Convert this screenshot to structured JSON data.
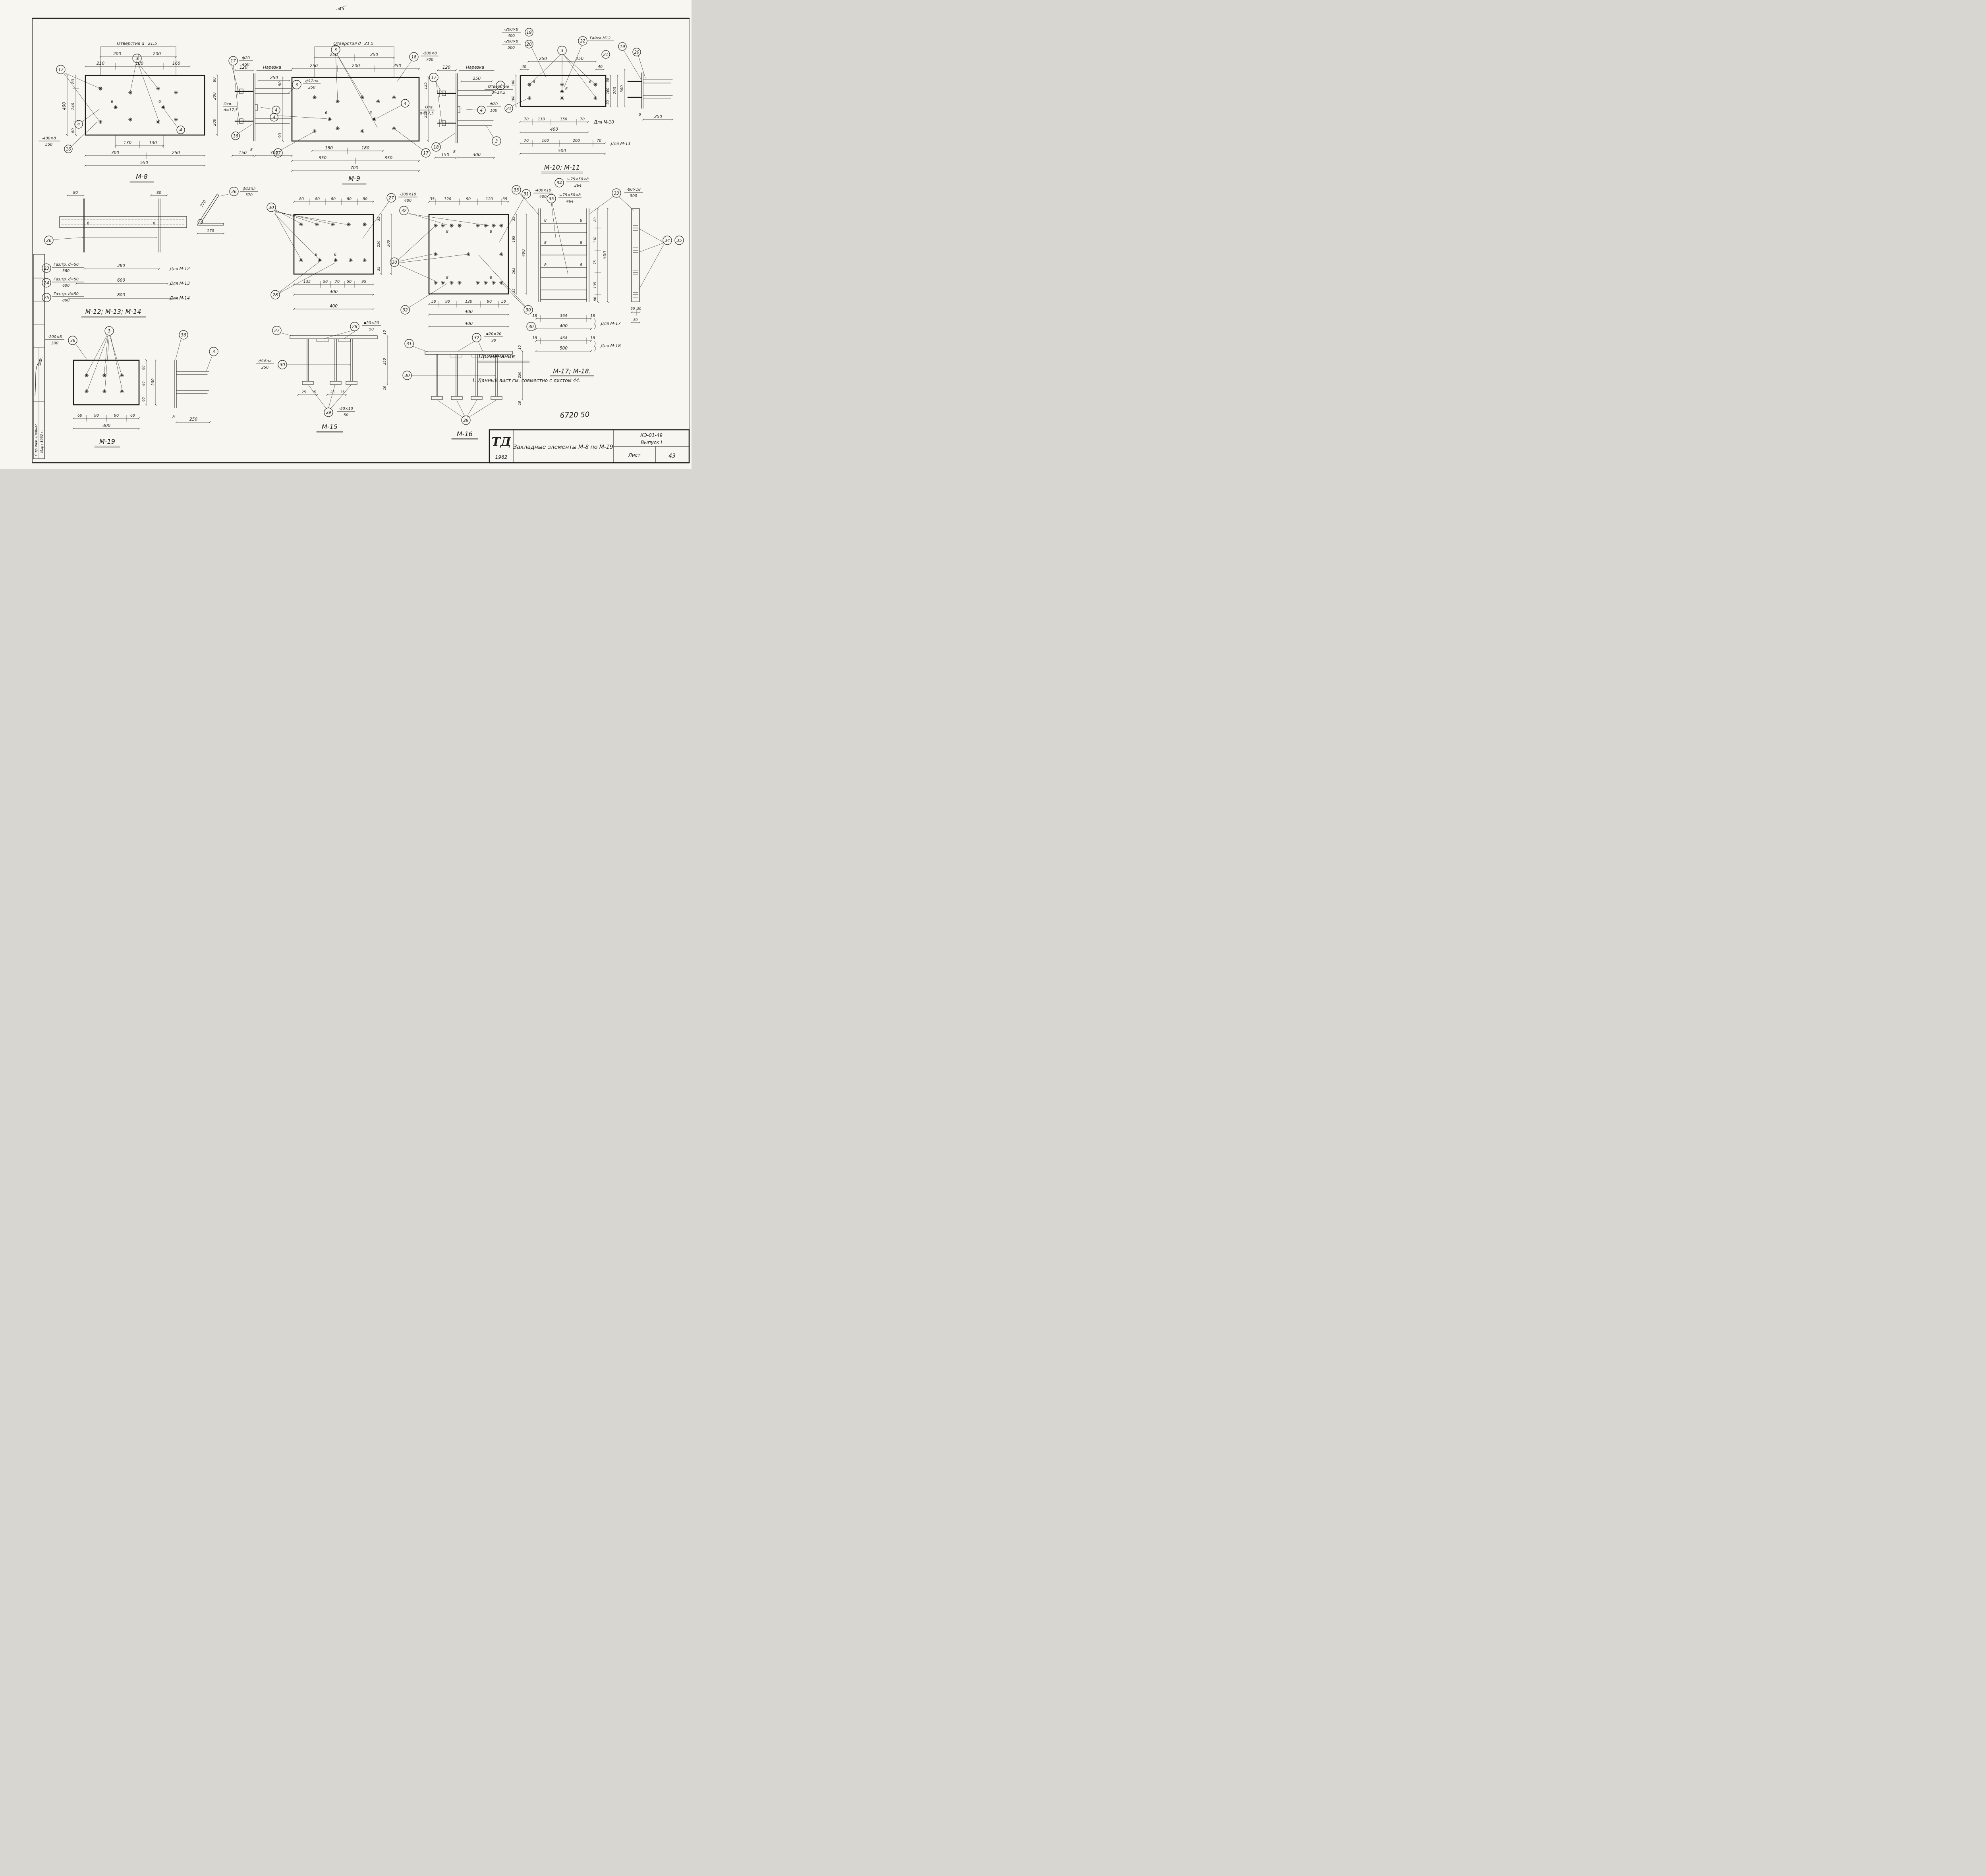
{
  "page": {
    "corner_mark": "45",
    "handnote": "6720 50",
    "ink": "#1d1d1b",
    "paper": "#f7f6f1"
  },
  "titleblock": {
    "logo": "ТД",
    "year": "1962",
    "title": "Закладные элементы М-8 по М-19",
    "doc": "КЭ-01-49",
    "issue": "Выпуск I",
    "sheet_label": "Лист",
    "sheet_no": "43"
  },
  "notes": {
    "heading": "Примечания",
    "item1": "1. Данный лист см. совместно с листом 44."
  },
  "stamp": {
    "sig_label": "С.тр.инж. Шейнес",
    "date_label": "Март 1962 г."
  },
  "views": {
    "m8": {
      "label": "М-8",
      "holes_note": "Отверстия d=21,5",
      "t200a": "200",
      "t200b": "200",
      "t210": "210",
      "t180": "180",
      "t160": "160",
      "l80a": "80",
      "l240": "240",
      "l80b": "80",
      "l400": "400",
      "r80": "80",
      "s200a": "200",
      "s200b": "200",
      "otv": "Отв.",
      "otv_d": "d=17,5",
      "w6a": "6",
      "w6b": "6",
      "b130a": "130",
      "b130b": "130",
      "b300": "300",
      "b250": "250",
      "b550": "550",
      "note16_num": "-400×8",
      "note16_den": "550",
      "note17_num": "ф20",
      "note17_den": "450",
      "note3_num": "ф12пл",
      "note3_den": "250",
      "s120": "120",
      "thread": "Нарезка",
      "s250": "250",
      "s8": "8",
      "s150": "150",
      "s300": "300",
      "c17l": "17",
      "c3": "3",
      "c17r": "17",
      "c4a": "4",
      "c4b": "4",
      "c4c": "4",
      "c16a": "16",
      "c16b": "16",
      "c3r": "3"
    },
    "m9": {
      "label": "М-9",
      "holes_note": "Отверстия d=21,5",
      "t250a": "250",
      "t250b": "250",
      "r250a": "250",
      "r200": "200",
      "r250b": "250",
      "note18_num": "-500×8",
      "note18_den": "700",
      "l90a": "90",
      "l90b": "90",
      "rv125": "125",
      "rv250": "250",
      "otv": "Отв.",
      "otv_d": "d=17,5",
      "w6a": "6",
      "w6b": "6",
      "b180a": "180",
      "b180b": "180",
      "b350a": "350",
      "b350b": "350",
      "b700": "700",
      "s120": "120",
      "thread": "Нарезка",
      "s250": "250",
      "s8": "8",
      "s150": "150",
      "s300": "300",
      "c3": "3",
      "c18": "18",
      "c4a": "4",
      "c4b": "4",
      "c17a": "17",
      "c17b": "17",
      "c17s": "17",
      "c18s": "18",
      "c3s": "3",
      "c3sb": "3",
      "c4s": "4"
    },
    "m1011": {
      "label": "М-10; М-11",
      "note19_num": "-200×8",
      "note19_den": "400",
      "note20_num": "-200×8",
      "note20_den": "500",
      "nut": "Гайка М12",
      "t250a": "250",
      "t250b": "250",
      "t40a": "40",
      "t40b": "40",
      "otv": "Отверстие",
      "otv_d": "d=14,5",
      "note21_num": "ф20",
      "note21_den": "100",
      "l100a": "100",
      "l100b": "100",
      "rv50a": "50",
      "rv100": "100",
      "rv50b": "50",
      "rv200": "200",
      "rv300": "300",
      "w6a": "6",
      "w6b": "6",
      "w6c": "6",
      "row1": [
        "70",
        "110",
        "150",
        "70"
      ],
      "row1_total": "400",
      "row1_for": "Для М-10",
      "row2": [
        "70",
        "160",
        "200",
        "70"
      ],
      "row2_total": "500",
      "row2_for": "Для М-11",
      "s8": "8",
      "s250": "250",
      "c19a": "19",
      "c19b": "19",
      "c20a": "20",
      "c20b": "20",
      "c21a": "21",
      "c21b": "21",
      "c22": "22",
      "c3": "3"
    },
    "m121314": {
      "label": "М-12; М-13; М-14",
      "t80a": "80",
      "t80b": "80",
      "w6a": "6",
      "w6b": "6",
      "c26a": "26",
      "c26b": "26",
      "c23": "23",
      "c24": "24",
      "c25": "25",
      "gas1": "Газ.тр. d=50",
      "gas2": "Газ.тр. d=50",
      "gas3": "Газ.тр. d=50",
      "den1": "380",
      "den2": "600",
      "den3": "800",
      "len1": "380",
      "len2": "600",
      "len3": "800",
      "for1": "Для М-12",
      "for2": "Для М-13",
      "for3": "Для М-14",
      "note26_num": "ф12пл",
      "note26_den": "570",
      "d270": "270",
      "d170": "170"
    },
    "m15": {
      "label": "М-15",
      "top": [
        "80",
        "80",
        "80",
        "80",
        "80"
      ],
      "c30a": "30",
      "c27a": "27",
      "note27_num": "-300×10",
      "note27_den": "400",
      "rv": [
        "35",
        "230",
        "35"
      ],
      "rv300": "300",
      "bot": [
        "135",
        "50",
        "70",
        "50",
        "95"
      ],
      "b400": "400",
      "w6a": "6",
      "w6b": "6",
      "c28a": "28",
      "c27s": "27",
      "c28s": "28",
      "note28_num": "▪20×20",
      "note28_den": "50",
      "s400": "400",
      "sv": [
        "10",
        "250",
        "10"
      ],
      "note30_num": "ф16пл",
      "note30_den": "250",
      "c30s": "30",
      "sb": [
        "25",
        "35",
        "25",
        "35"
      ],
      "c29": "29",
      "note29_num": "-50×10",
      "note29_den": "50"
    },
    "m16": {
      "label": "М-16",
      "top": [
        "35",
        "120",
        "90",
        "120",
        "35"
      ],
      "c31a": "31",
      "note31_num": "-400×10",
      "note31_den": "400",
      "c32a": "32",
      "c32b": "32",
      "c32s": "32",
      "c30a": "30",
      "c30b": "30",
      "c30s": "30",
      "c30t": "30",
      "w8": [
        "8",
        "8",
        "8",
        "8"
      ],
      "rv": [
        "35",
        "165",
        "165",
        "35"
      ],
      "rv400": "400",
      "bot": [
        "50",
        "90",
        "120",
        "90",
        "50"
      ],
      "b400": "400",
      "s400": "400",
      "sv": [
        "10",
        "250",
        "10"
      ],
      "c31s": "31",
      "note32_num": "▪20×20",
      "note32_den": "90",
      "c29": "29"
    },
    "m1718": {
      "label": "М-17; М-18.",
      "c33a": "33",
      "c33b": "33",
      "c34a": "34",
      "c34b": "34",
      "c35a": "35",
      "c35b": "35",
      "note34_num": "∟75×50×8",
      "note34_den": "364",
      "note35_num": "∟75×50×8",
      "note35_den": "464",
      "note33_num": "-80×18",
      "note33_den": "500",
      "w8": [
        "8",
        "8",
        "8",
        "8",
        "8",
        "8"
      ],
      "mv": [
        "80",
        "130",
        "75",
        "135",
        "80"
      ],
      "mv500": "500",
      "row1": [
        "18",
        "364",
        "18"
      ],
      "row1_total": "400",
      "row1_for": "Для М-17",
      "row2": [
        "18",
        "464",
        "18"
      ],
      "row2_total": "500",
      "row2_for": "Для М-18",
      "sv50": "50",
      "sv30": "30",
      "sv80": "80"
    },
    "m19": {
      "label": "М-19",
      "c36a": "36",
      "c36b": "36",
      "note36_num": "-200×8",
      "note36_den": "300",
      "c3a": "3",
      "c3s": "3",
      "rv": [
        "60",
        "80",
        "60"
      ],
      "rv200": "200",
      "bot": [
        "60",
        "90",
        "90",
        "60"
      ],
      "b300": "300",
      "s8": "8",
      "s250": "250"
    }
  }
}
